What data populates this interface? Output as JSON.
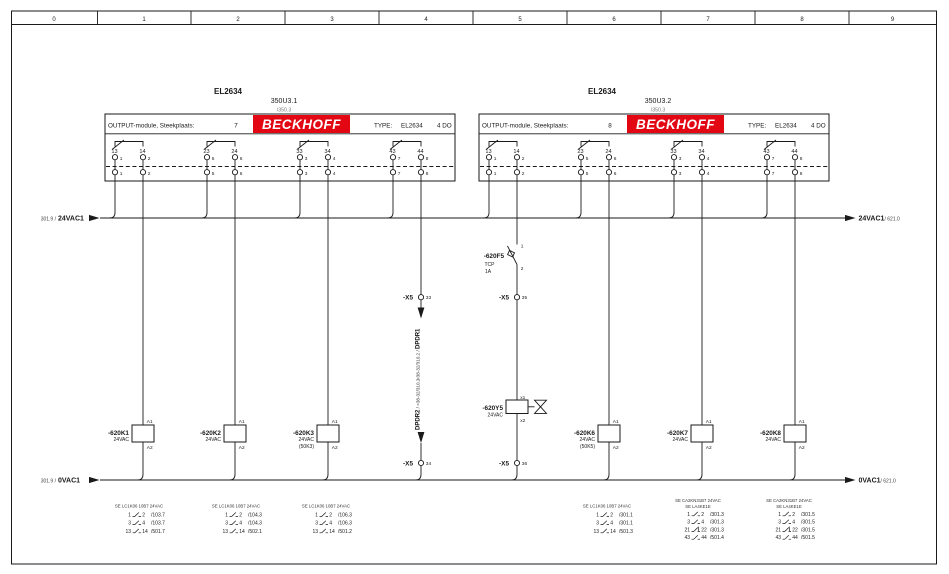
{
  "ruler": [
    "0",
    "1",
    "2",
    "3",
    "4",
    "5",
    "6",
    "7",
    "8",
    "9"
  ],
  "modules": [
    {
      "part": "EL2634",
      "device": "350U3.1",
      "device_ref": "/350.3",
      "header": "OUTPUT-module, Steekplaats:",
      "slot": "7",
      "brand": "BECKHOFF",
      "type_label": "TYPE:",
      "type_value": "EL2634",
      "io": "4 DO",
      "pairs": [
        {
          "t1": "13",
          "t2": "14",
          "p1": "1",
          "p2": "2"
        },
        {
          "t1": "23",
          "t2": "24",
          "p1": "5",
          "p2": "6"
        },
        {
          "t1": "33",
          "t2": "34",
          "p1": "3",
          "p2": "4"
        },
        {
          "t1": "43",
          "t2": "44",
          "p1": "7",
          "p2": "8"
        }
      ]
    },
    {
      "part": "EL2634",
      "device": "350U3.2",
      "device_ref": "/350.3",
      "header": "OUTPUT-module, Steekplaats:",
      "slot": "8",
      "brand": "BECKHOFF",
      "type_label": "TYPE:",
      "type_value": "EL2634",
      "io": "4 DO",
      "pairs": [
        {
          "t1": "13",
          "t2": "14",
          "p1": "1",
          "p2": "2"
        },
        {
          "t1": "23",
          "t2": "24",
          "p1": "5",
          "p2": "6"
        },
        {
          "t1": "33",
          "t2": "34",
          "p1": "3",
          "p2": "4"
        },
        {
          "t1": "43",
          "t2": "44",
          "p1": "7",
          "p2": "8"
        }
      ]
    }
  ],
  "buses": {
    "top": {
      "src": "301.9 /",
      "name": "24VAC1",
      "dst": "/ 621.0"
    },
    "bottom": {
      "src": "301.9 /",
      "name": "0VAC1",
      "dst": "/ 621.0"
    }
  },
  "labels": {
    "a1": "A1",
    "a2": "A2"
  },
  "breaker": {
    "tag": "-620F5",
    "kind": "TCP",
    "rating": "1A",
    "t1": "1",
    "t2": "2"
  },
  "valve": {
    "tag": "-620Y5",
    "voltage": "24VAC",
    "t1": "x1",
    "t2": "x2"
  },
  "terminal_strip": {
    "name": "-X5",
    "t33": "33",
    "t34": "34",
    "t35": "35",
    "t36": "36"
  },
  "signals": {
    "dpdr1_ref": "=38-32/310.2 / ",
    "dpdr1": "DPDR1",
    "dpdr2": "DPDR2",
    "dpdr2_ref": " / =38-32/310.2"
  },
  "coils": [
    {
      "tag": "-620K1",
      "voltage": "24VAC"
    },
    {
      "tag": "-620K2",
      "voltage": "24VAC"
    },
    {
      "tag": "-620K3",
      "voltage": "24VAC",
      "note": "(50K3)"
    },
    {
      "tag": "-620K6",
      "voltage": "24VAC",
      "note": "(50K5)"
    },
    {
      "tag": "-620K7",
      "voltage": "24VAC"
    },
    {
      "tag": "-620K8",
      "voltage": "24VAC"
    }
  ],
  "xrefs": [
    {
      "header": "SE LC1K06 10B7 24VAC",
      "rows": [
        {
          "a": "1",
          "b": "2",
          "ref": "/103.7"
        },
        {
          "a": "3",
          "b": "4",
          "ref": "/103.7"
        },
        {
          "a": "13",
          "b": "14",
          "ref": "/501.7"
        }
      ]
    },
    {
      "header": "SE LC1K06 10B7 24VAC",
      "rows": [
        {
          "a": "1",
          "b": "2",
          "ref": "/104.3"
        },
        {
          "a": "3",
          "b": "4",
          "ref": "/104.3"
        },
        {
          "a": "13",
          "b": "14",
          "ref": "/502.1"
        }
      ]
    },
    {
      "header": "SE LC1K06 10B7 24VAC",
      "rows": [
        {
          "a": "1",
          "b": "2",
          "ref": "/106.3"
        },
        {
          "a": "3",
          "b": "4",
          "ref": "/106.3"
        },
        {
          "a": "13",
          "b": "14",
          "ref": "/501.2"
        }
      ]
    },
    {
      "header": "SE LC1K06 10B7 24VAC",
      "rows": [
        {
          "a": "1",
          "b": "2",
          "ref": "/301.1"
        },
        {
          "a": "3",
          "b": "4",
          "ref": "/301.1"
        },
        {
          "a": "13",
          "b": "14",
          "ref": "/501.3"
        }
      ]
    },
    {
      "header": "SE CA2KN31B7 24VAC",
      "header2": "SE LA4KE1E",
      "rows": [
        {
          "a": "1",
          "b": "2",
          "ref": "/301.3"
        },
        {
          "a": "3",
          "b": "4",
          "ref": "/301.3"
        },
        {
          "a": "21",
          "b": "22",
          "ref": "/301.3"
        },
        {
          "a": "43",
          "b": "44",
          "ref": "/501.4"
        }
      ]
    },
    {
      "header": "SE CA2KN31B7 24VAC",
      "header2": "SE LA4KE1E",
      "rows": [
        {
          "a": "1",
          "b": "2",
          "ref": "/301.5"
        },
        {
          "a": "3",
          "b": "4",
          "ref": "/301.5"
        },
        {
          "a": "21",
          "b": "22",
          "ref": "/301.5"
        },
        {
          "a": "43",
          "b": "44",
          "ref": "/501.5"
        }
      ]
    }
  ],
  "colors": {
    "brand_red": "#e30613",
    "line": "#1a1a1a",
    "paper": "#ffffff"
  }
}
